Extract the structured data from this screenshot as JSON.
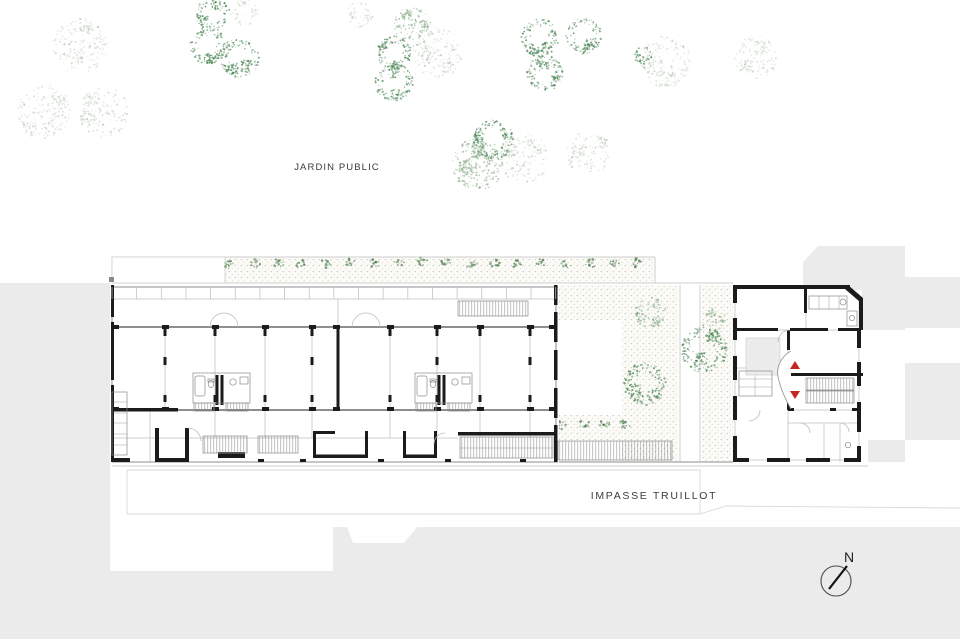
{
  "labels": {
    "public_garden": "JARDIN PUBLIC",
    "street": "IMPASSE TRUILLOT",
    "compass_north": "N"
  },
  "colors": {
    "background": "#ffffff",
    "context_gray": "#ebebec",
    "wall_black": "#1b1b1b",
    "accent_red": "#c5271d",
    "tree_dark": "#4e8a57",
    "tree_mid": "#83aa83",
    "tree_light": "#bccdb8",
    "stipple_dot": "#aab6a2"
  },
  "vegetation": {
    "trees": [
      {
        "x": 80,
        "y": 46,
        "r": 27,
        "s": "light"
      },
      {
        "x": 44,
        "y": 112,
        "r": 27,
        "s": "light"
      },
      {
        "x": 104,
        "y": 112,
        "r": 25,
        "s": "light"
      },
      {
        "x": 213,
        "y": 14,
        "r": 17,
        "s": "dark"
      },
      {
        "x": 244,
        "y": 12,
        "r": 14,
        "s": "light"
      },
      {
        "x": 208,
        "y": 46,
        "r": 18,
        "s": "dark"
      },
      {
        "x": 239,
        "y": 58,
        "r": 20,
        "s": "dark"
      },
      {
        "x": 412,
        "y": 28,
        "r": 20,
        "s": "mid"
      },
      {
        "x": 394,
        "y": 53,
        "r": 17,
        "s": "dark"
      },
      {
        "x": 438,
        "y": 53,
        "r": 25,
        "s": "light"
      },
      {
        "x": 394,
        "y": 82,
        "r": 19,
        "s": "dark"
      },
      {
        "x": 360,
        "y": 14,
        "r": 13,
        "s": "light"
      },
      {
        "x": 540,
        "y": 38,
        "r": 19,
        "s": "dark"
      },
      {
        "x": 584,
        "y": 36,
        "r": 18,
        "s": "dark"
      },
      {
        "x": 545,
        "y": 73,
        "r": 18,
        "s": "dark"
      },
      {
        "x": 666,
        "y": 62,
        "r": 26,
        "s": "light"
      },
      {
        "x": 643,
        "y": 55,
        "r": 9,
        "s": "dark"
      },
      {
        "x": 756,
        "y": 57,
        "r": 22,
        "s": "light"
      },
      {
        "x": 493,
        "y": 140,
        "r": 20,
        "s": "dark"
      },
      {
        "x": 478,
        "y": 164,
        "r": 26,
        "s": "mid"
      },
      {
        "x": 524,
        "y": 158,
        "r": 25,
        "s": "light"
      },
      {
        "x": 588,
        "y": 153,
        "r": 22,
        "s": "light"
      },
      {
        "x": 650,
        "y": 313,
        "r": 16,
        "s": "mid"
      },
      {
        "x": 645,
        "y": 384,
        "r": 21,
        "s": "dark"
      },
      {
        "x": 704,
        "y": 350,
        "r": 23,
        "s": "dark"
      },
      {
        "x": 714,
        "y": 320,
        "r": 12,
        "s": "mid"
      }
    ],
    "hedges": [
      {
        "x1": 230,
        "y": 263,
        "x2": 648,
        "step": 24
      },
      {
        "x1": 562,
        "y": 424,
        "x2": 644,
        "step": 21
      }
    ]
  }
}
